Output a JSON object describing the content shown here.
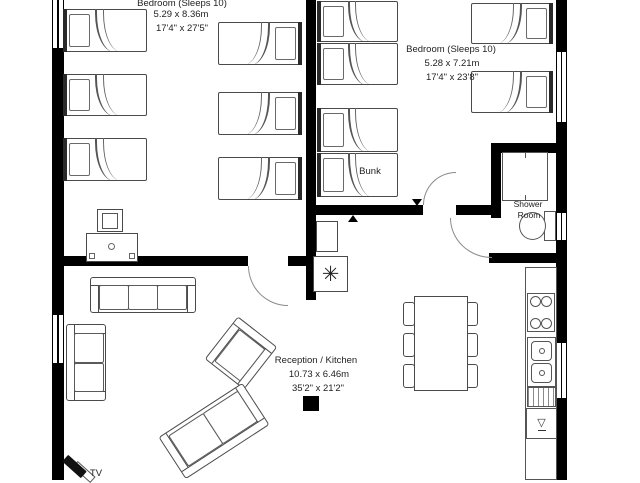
{
  "rooms": {
    "bedroom_left": {
      "name": "Bedroom (Sleeps 10)",
      "metric": "5.29 x 8.36m",
      "imperial": "17'4\" x 27'5\""
    },
    "bedroom_right": {
      "name": "Bedroom (Sleeps 10)",
      "metric": "5.28 x 7.21m",
      "imperial": "17'4\" x 23'8\""
    },
    "reception_kitchen": {
      "name": "Reception / Kitchen",
      "metric": "10.73 x 6.46m",
      "imperial": "35'2\" x 21'2\""
    },
    "shower_room": {
      "name_line1": "Shower",
      "name_line2": "Room"
    }
  },
  "labels": {
    "bunk": "Bunk",
    "tv": "TV"
  },
  "symbols": {
    "boiler_fan": "✳",
    "dishwasher_glass": "▽"
  },
  "colors": {
    "wall": "#000000",
    "furniture_line": "#4a4a4a",
    "text": "#222222",
    "background": "#ffffff"
  }
}
